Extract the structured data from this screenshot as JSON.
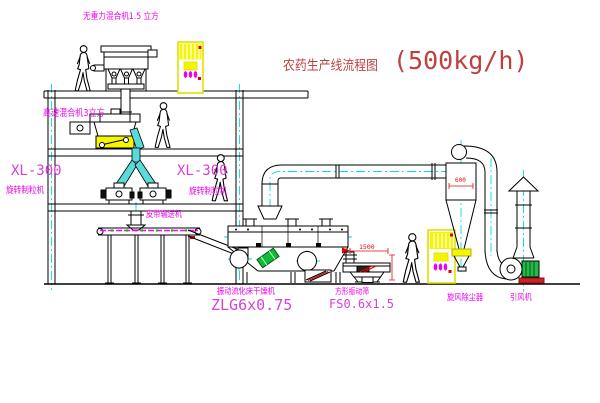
{
  "title": {
    "text": "农药生产线流程图",
    "capacity": "(500kg/h)"
  },
  "labels": {
    "top_mixer": "无重力混合机1.5 立方",
    "highspeed_mixer": "高速混合机3立方",
    "xl300_left": "XL-300",
    "xl300_left_sub": "旋转制粒机",
    "xl300_mid": "XL-300",
    "xl300_mid_sub": "旋转制粒机",
    "belt_conveyor": "皮带输送机",
    "dryer": "振动流化床干燥机",
    "dryer_model": "ZLG6x0.75",
    "sieve": "方形振动筛",
    "sieve_model": "FS0.6x1.5",
    "cyclone": "旋风除尘器",
    "fan": "引风机"
  },
  "dimensions": {
    "cyclone_dia": "600",
    "sieve_width": "1500"
  },
  "colors": {
    "label_magenta": "#F000F0",
    "model_magenta": "#D840D8",
    "title_red": "#C04040",
    "dimension_red": "#E01010",
    "centerline_cyan": "#00DEDE",
    "pipe_cyan": "#5ADBDB",
    "equipment_yellow": "#F5F500",
    "machine_green": "#22BB44",
    "base_red": "#CC2222",
    "line_black": "#000000"
  }
}
